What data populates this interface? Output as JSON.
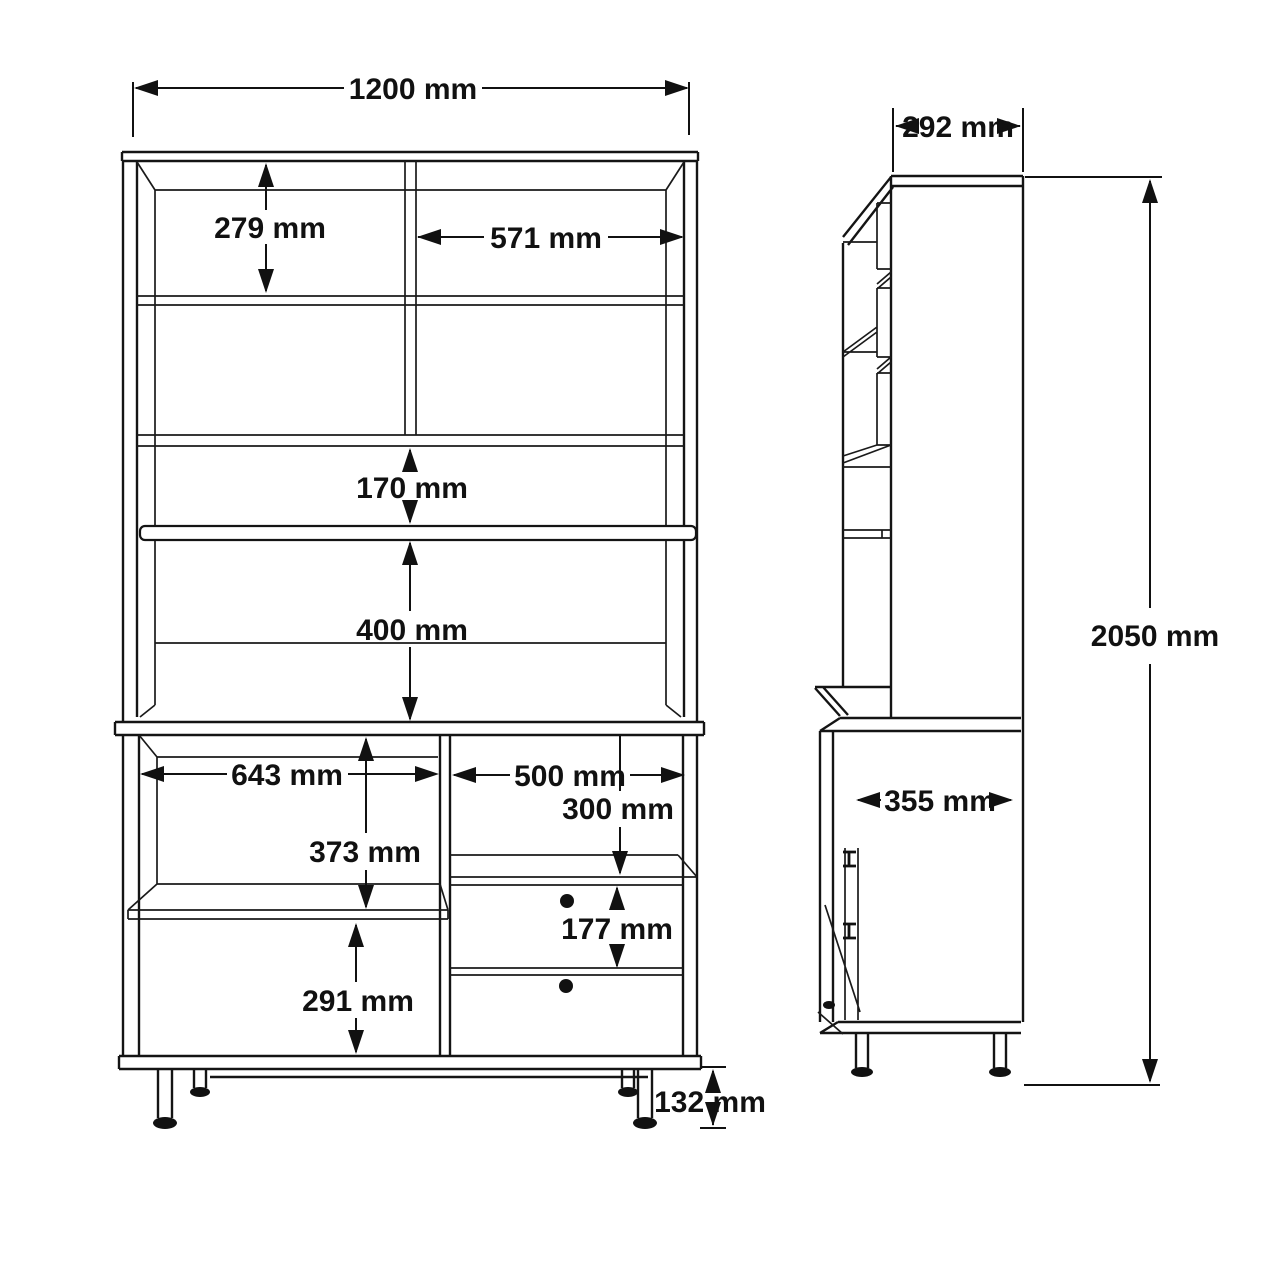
{
  "drawing": {
    "type": "furniture-technical-drawing",
    "unit": "mm",
    "line_color": "#111111",
    "background": "#ffffff",
    "front_view": {
      "dims": {
        "overall_width": "1200 mm",
        "upper_left_compartment_height": "279 mm",
        "upper_right_compartment_width": "571 mm",
        "middle_shelf_gap": "170 mm",
        "open_shelf_height": "400 mm",
        "lower_left_compartment_width": "643 mm",
        "lower_right_compartment_width": "500 mm",
        "drawer_recess_height": "300 mm",
        "lower_left_upper_height": "373 mm",
        "drawer_height": "177 mm",
        "lower_left_bottom_height": "291 mm",
        "leg_height": "132 mm"
      }
    },
    "side_view": {
      "dims": {
        "upper_depth": "292 mm",
        "overall_height": "2050 mm",
        "lower_depth": "355 mm"
      }
    }
  }
}
